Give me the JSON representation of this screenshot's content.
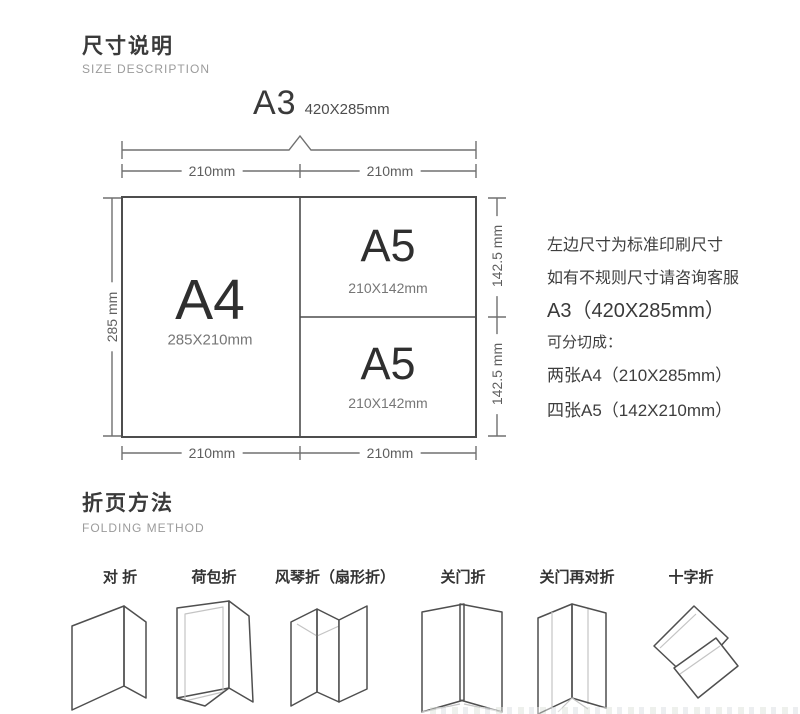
{
  "size_section": {
    "title": "尺寸说明",
    "subtitle": "SIZE DESCRIPTION",
    "a3_header": {
      "name": "A3",
      "dims": "420X285mm"
    },
    "dims": {
      "top_left": "210mm",
      "top_right": "210mm",
      "bottom_left": "210mm",
      "bottom_right": "210mm",
      "left_side": "285 mm",
      "right_top": "142.5 mm",
      "right_bottom": "142.5 mm"
    },
    "sheets": {
      "a4": {
        "name": "A4",
        "size": "285X210mm"
      },
      "a5_top": {
        "name": "A5",
        "size": "210X142mm"
      },
      "a5_bottom": {
        "name": "A5",
        "size": "210X142mm"
      }
    },
    "notes": {
      "line1": "左边尺寸为标准印刷尺寸",
      "line2": "如有不规则尺寸请咨询客服",
      "line3": "A3（420X285mm）",
      "line4": "可分切成：",
      "line5": "两张A4（210X285mm）",
      "line6": "四张A5（142X210mm）"
    }
  },
  "folding_section": {
    "title": "折页方法",
    "subtitle": "FOLDING METHOD",
    "methods": [
      {
        "label": "对 折",
        "icon": "half-fold-icon"
      },
      {
        "label": "荷包折",
        "icon": "wallet-fold-icon"
      },
      {
        "label": "风琴折（扇形折）",
        "icon": "accordion-fold-icon"
      },
      {
        "label": "关门折",
        "icon": "gate-fold-icon"
      },
      {
        "label": "关门再对折",
        "icon": "gate-half-fold-icon"
      },
      {
        "label": "十字折",
        "icon": "cross-fold-icon"
      }
    ]
  },
  "colors": {
    "text_dark": "#3a3a3a",
    "text_gray": "#9b9b9b",
    "line_gray": "#707070",
    "outline_dark": "#4d4d4d",
    "background": "#ffffff"
  }
}
